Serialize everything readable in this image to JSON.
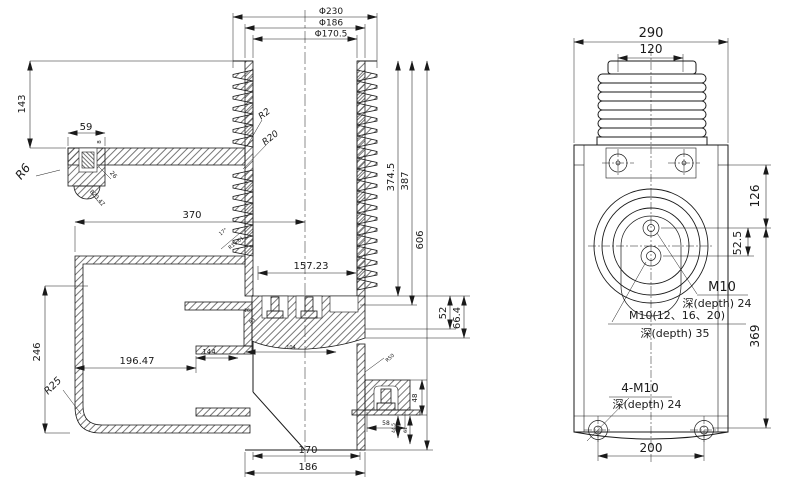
{
  "left": {
    "dims": {
      "d230": "Φ230",
      "d186": "Φ186",
      "d170": "Φ170.5",
      "h143": "143",
      "w59": "59",
      "t8": "8",
      "w370": "370",
      "w157": "157.23",
      "h246": "246",
      "w196": "196.47",
      "w144": "144",
      "w104": "104",
      "h52": "52",
      "h66": "66.4",
      "h374": "374.5",
      "h387": "387",
      "h606": "606",
      "h48": "48",
      "w58": "58",
      "h44": "44.5",
      "h61": "61",
      "t16": "16",
      "w170": "170",
      "w186": "186"
    },
    "radii": {
      "r6": "R6",
      "r23": "R23.47",
      "a26": "26",
      "r2": "R2",
      "r20": "R20",
      "a17": "17°",
      "r15": "R15.01",
      "r25": "R25",
      "r50": "R50",
      "r3": "R3"
    }
  },
  "right": {
    "dims": {
      "w290": "290",
      "w120": "120",
      "h126": "126",
      "h52": "52.5",
      "h369": "369",
      "w200": "200"
    },
    "callouts": {
      "m10": "M10",
      "m10_depth": "深(depth) 24",
      "m10_multi": "M10(12、16、20)",
      "m10_multi_depth": "深(depth) 35",
      "corner_bolts": "4-M10",
      "corner_bolts_depth": "深(depth) 24"
    }
  },
  "colors": {
    "line": "#1a1a1a",
    "background": "#ffffff"
  }
}
